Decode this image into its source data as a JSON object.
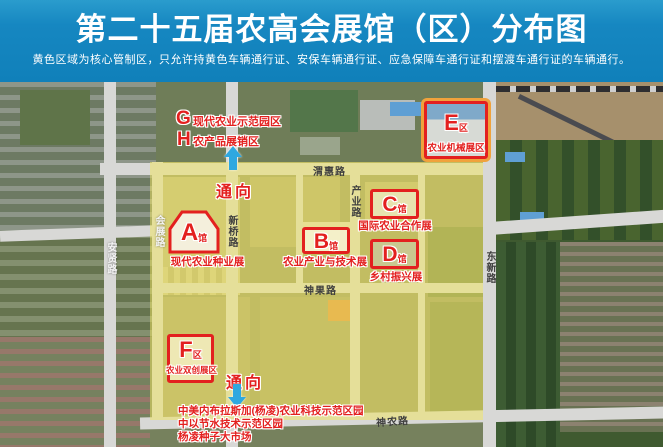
{
  "header": {
    "title": "第二十五届农高会展馆（区）分布图",
    "subtitle": "黄色区域为核心管制区，只允许持黄色车辆通行证、安保车辆通行证、应急保障车通行证和摆渡车通行证的车辆通行。"
  },
  "map": {
    "roads": {
      "weihui": "渭惠路",
      "chanye": "产业路",
      "xinqiao": "新桥路",
      "huizhan": "会展路",
      "anxian": "安贤路",
      "dongxin": "东新路",
      "shenguo": "神果路",
      "shennong": "神农路"
    },
    "venues": [
      {
        "letter": "A",
        "suffix": "馆",
        "name": "现代农业种业展"
      },
      {
        "letter": "B",
        "suffix": "馆",
        "name": "农业产业与技术展"
      },
      {
        "letter": "C",
        "suffix": "馆",
        "name": "国际农业合作展"
      },
      {
        "letter": "D",
        "suffix": "馆",
        "name": "乡村振兴展"
      },
      {
        "letter": "E",
        "suffix": "区",
        "name": "农业机械展区"
      },
      {
        "letter": "F",
        "suffix": "区",
        "name": "农业双创展区"
      },
      {
        "letter": "G",
        "suffix": "",
        "name": "现代农业示范园区"
      },
      {
        "letter": "H",
        "suffix": "",
        "name": "农产品展销区"
      }
    ],
    "arrows": {
      "top": "通向",
      "bottom": "通向"
    },
    "notes": [
      "中美内布拉斯加(杨凌)农业科技示范区园",
      "中以节水技术示范区园",
      "杨凌种子大市场"
    ],
    "colors": {
      "banner_blue": "#1687c1",
      "marker_red": "#e3201f",
      "zone_yellow": "#f2e662",
      "arrow_blue": "#2fa8e0",
      "road_gray": "#d8d8d6"
    }
  }
}
